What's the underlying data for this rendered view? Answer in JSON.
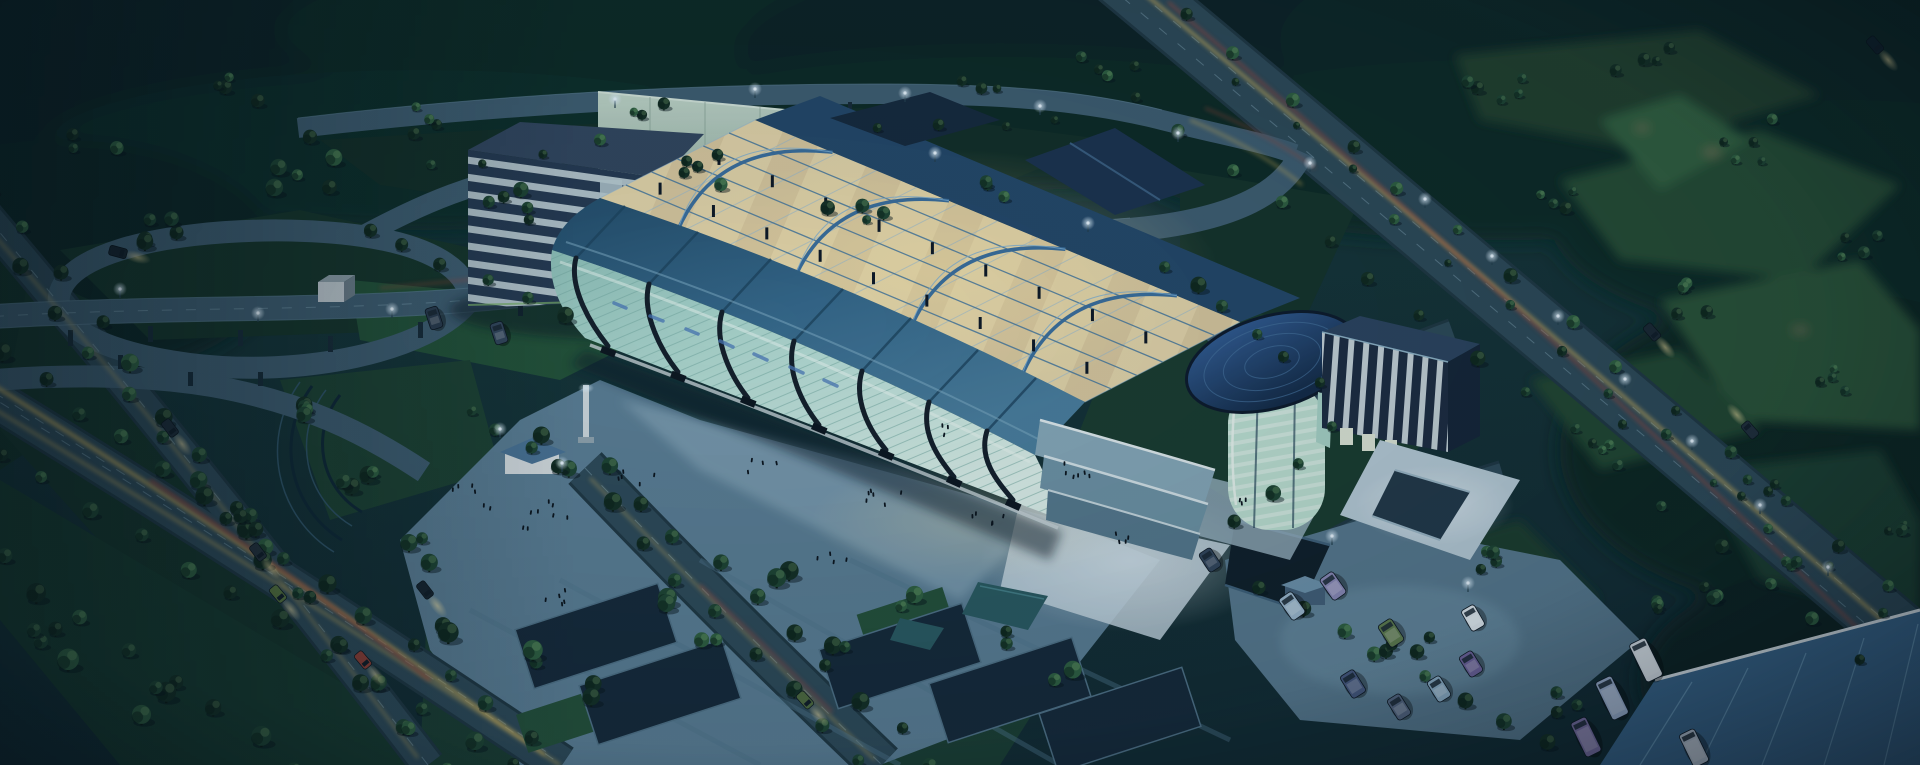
{
  "scene": {
    "subject": "aerial night rendering of a glass exhibition and convention center campus",
    "time_of_day": "dusk",
    "style": "3d-architectural-visualization",
    "features": [
      "highway interchange",
      "office block",
      "curved glass exhibition hall",
      "open steel roof truss",
      "glass tower with dome",
      "plaza with people",
      "tree-lined boulevards with light trails",
      "parking lot with vans and buses",
      "golf course and forest backdrop"
    ]
  },
  "palette": {
    "sky_top": "#0e2730",
    "terrain": "#143136",
    "forest": "#0d2524",
    "lawn": "#16352b",
    "golf_green": "#2c5339",
    "road": "#2e4a59",
    "road_elevated": "#3f5e72",
    "road_casing": "#203844",
    "lane_dash": "#7fa2b4",
    "trail_yellow": "#d7b75e",
    "trail_red": "#a8473a",
    "plaza": "#5b7e95",
    "plaza_lit": "#9db8c8",
    "pool": "#16293a",
    "water": "#2a5a62",
    "glass": "#a8d2ca",
    "glass_light": "#d9efe9",
    "mullion": "#76aaa4",
    "rib": "#141f2b",
    "roof_steel": "#2c5878",
    "roof_steel_light": "#4f88a6",
    "truss_warm": "#d9c89f",
    "truss_bright": "#f0e2b6",
    "truss_blue": "#3b6f9e",
    "navy_building": "#263a52",
    "navy_dark": "#1d2c42",
    "stripe": "#b2c3cb",
    "slab_glass": "#aec6ba",
    "dome": "#1e3d60",
    "cylinder": "#bfe2d4",
    "wing_strip": "#d9e6ea",
    "parking": "#58798f",
    "canopy": "#3a678e",
    "glow_warm": "#ffe9a8",
    "glow_cool": "#dff2ff",
    "tree_dark": "#142f25",
    "tree_mid": "#1e4433",
    "tree_light": "#2f5f41"
  },
  "truss": {
    "front": [
      600,
      198,
      1085,
      402
    ],
    "back": [
      755,
      120,
      1240,
      322
    ],
    "arc_ts": [
      0.16,
      0.4,
      0.64,
      0.87
    ],
    "post_ks": [
      0.2,
      0.58
    ],
    "posts_per_line": 9
  },
  "vegetation": {
    "tree_rows": [
      [
        -5,
        185,
        400,
        730,
        13,
        1.0
      ],
      [
        20,
        268,
        445,
        765,
        13,
        1.0
      ],
      [
        0,
        352,
        530,
        735,
        14,
        1.05
      ],
      [
        -5,
        452,
        520,
        765,
        12,
        1.05
      ],
      [
        0,
        560,
        300,
        765,
        8,
        1.1
      ],
      [
        535,
        430,
        860,
        760,
        10,
        1.0
      ],
      [
        605,
        468,
        935,
        765,
        10,
        1.0
      ],
      [
        1082,
        55,
        1862,
        658,
        17,
        0.85
      ],
      [
        1185,
        12,
        1948,
        630,
        15,
        0.8
      ],
      [
        1240,
        85,
        1880,
        615,
        13,
        0.6
      ],
      [
        1258,
        592,
        1545,
        742,
        8,
        0.9
      ],
      [
        1162,
        262,
        1315,
        382,
        6,
        0.9
      ],
      [
        368,
        232,
        562,
        318,
        6,
        1.0
      ],
      [
        430,
        168,
        600,
        144,
        4,
        0.7
      ],
      [
        880,
        128,
        1060,
        118,
        4,
        0.7
      ],
      [
        1330,
        430,
        1240,
        520,
        4,
        0.9
      ],
      [
        470,
        415,
        560,
        470,
        4,
        0.9
      ]
    ],
    "tree_clusters": [
      [
        150,
        215,
        45,
        5,
        1.0
      ],
      [
        305,
        165,
        50,
        6,
        1.0
      ],
      [
        520,
        205,
        40,
        5,
        0.9
      ],
      [
        705,
        168,
        40,
        5,
        0.85
      ],
      [
        862,
        205,
        35,
        4,
        0.8
      ],
      [
        435,
        122,
        35,
        4,
        0.8
      ],
      [
        245,
        95,
        35,
        4,
        0.8
      ],
      [
        645,
        108,
        30,
        3,
        0.7
      ],
      [
        1000,
        195,
        30,
        3,
        0.75
      ],
      [
        92,
        145,
        28,
        3,
        0.8
      ],
      [
        452,
        620,
        22,
        2,
        1.2
      ],
      [
        525,
        658,
        20,
        2,
        1.15
      ],
      [
        650,
        602,
        20,
        2,
        1.1
      ],
      [
        708,
        648,
        18,
        2,
        1.1
      ],
      [
        778,
        578,
        18,
        2,
        1.05
      ],
      [
        598,
        692,
        18,
        2,
        1.1
      ],
      [
        835,
        642,
        16,
        2,
        1.0
      ],
      [
        908,
        602,
        16,
        2,
        1.0
      ],
      [
        1000,
        640,
        18,
        2,
        1.0
      ],
      [
        1068,
        678,
        18,
        2,
        1.0
      ],
      [
        300,
        422,
        30,
        4,
        0.95
      ],
      [
        362,
        482,
        28,
        4,
        0.95
      ],
      [
        252,
        522,
        26,
        3,
        1.0
      ],
      [
        420,
        552,
        24,
        3,
        1.0
      ],
      [
        1502,
        92,
        40,
        5,
        0.75
      ],
      [
        1645,
        62,
        35,
        4,
        0.7
      ],
      [
        1762,
        142,
        40,
        5,
        0.75
      ],
      [
        1852,
        242,
        35,
        4,
        0.7
      ],
      [
        1562,
        202,
        32,
        4,
        0.7
      ],
      [
        1700,
        302,
        36,
        5,
        0.7
      ],
      [
        1832,
        382,
        30,
        4,
        0.7
      ],
      [
        1602,
        432,
        30,
        4,
        0.7
      ],
      [
        1752,
        482,
        28,
        4,
        0.7
      ],
      [
        1882,
        522,
        24,
        3,
        0.7
      ],
      [
        1502,
        562,
        28,
        4,
        0.75
      ],
      [
        1405,
        642,
        26,
        4,
        0.8
      ],
      [
        1652,
        602,
        22,
        3,
        0.75
      ],
      [
        1562,
        702,
        20,
        3,
        0.9
      ],
      [
        1705,
        598,
        22,
        3,
        0.8
      ],
      [
        1802,
        562,
        20,
        3,
        0.75
      ],
      [
        975,
        95,
        28,
        3,
        0.7
      ],
      [
        1120,
        70,
        26,
        3,
        0.65
      ],
      [
        60,
        640,
        40,
        4,
        1.2
      ],
      [
        140,
        700,
        36,
        3,
        1.2
      ]
    ]
  },
  "vehicles": {
    "parked": [
      {
        "x": 1292,
        "y": 606,
        "r": -35,
        "w": 16,
        "h": 26,
        "c": "#9db9cf"
      },
      {
        "x": 1333,
        "y": 586,
        "r": -35,
        "w": 16,
        "h": 26,
        "c": "#8b8ab8"
      },
      {
        "x": 1391,
        "y": 633,
        "r": -33,
        "w": 16,
        "h": 26,
        "c": "#5e7b4e"
      },
      {
        "x": 1473,
        "y": 618,
        "r": -30,
        "w": 15,
        "h": 24,
        "c": "#dfe8ee"
      },
      {
        "x": 1353,
        "y": 684,
        "r": -32,
        "w": 16,
        "h": 26,
        "c": "#46587e"
      },
      {
        "x": 1399,
        "y": 707,
        "r": -32,
        "w": 15,
        "h": 24,
        "c": "#54657f"
      },
      {
        "x": 1439,
        "y": 689,
        "r": -32,
        "w": 15,
        "h": 24,
        "c": "#8fb0c9"
      },
      {
        "x": 1471,
        "y": 664,
        "r": -32,
        "w": 15,
        "h": 24,
        "c": "#6f649c"
      },
      {
        "x": 1646,
        "y": 660,
        "r": -26,
        "w": 18,
        "h": 42,
        "c": "#dfe7ee"
      },
      {
        "x": 1612,
        "y": 698,
        "r": -26,
        "w": 18,
        "h": 42,
        "c": "#9fb2d2"
      },
      {
        "x": 1586,
        "y": 737,
        "r": -26,
        "w": 17,
        "h": 38,
        "c": "#7a6fa4"
      },
      {
        "x": 1694,
        "y": 748,
        "r": -26,
        "w": 17,
        "h": 36,
        "c": "#b9c4d4"
      },
      {
        "x": 434,
        "y": 318,
        "r": -18,
        "w": 13,
        "h": 22,
        "c": "#2a3b4e"
      },
      {
        "x": 499,
        "y": 333,
        "r": -18,
        "w": 13,
        "h": 22,
        "c": "#33465c"
      },
      {
        "x": 1210,
        "y": 560,
        "r": -33,
        "w": 14,
        "h": 22,
        "c": "#32455c"
      }
    ],
    "moving": [
      {
        "x": 170,
        "y": 428,
        "r": 143,
        "c": "#1d2b38"
      },
      {
        "x": 258,
        "y": 552,
        "r": 143,
        "c": "#24313c"
      },
      {
        "x": 278,
        "y": 594,
        "r": 140,
        "c": "#57743f"
      },
      {
        "x": 363,
        "y": 660,
        "r": 140,
        "c": "#8e3f36"
      },
      {
        "x": 425,
        "y": 590,
        "r": 142,
        "c": "#17242f"
      },
      {
        "x": 805,
        "y": 700,
        "r": 138,
        "c": "#4e6a3f"
      },
      {
        "x": 1652,
        "y": 332,
        "r": 139,
        "c": "#1a2733"
      },
      {
        "x": 1750,
        "y": 430,
        "r": -41,
        "c": "#202e3b"
      },
      {
        "x": 1875,
        "y": 45,
        "r": 139,
        "c": "#10202c"
      },
      {
        "x": 118,
        "y": 252,
        "r": 105,
        "c": "#16232e"
      }
    ]
  },
  "street_lights": [
    [
      615,
      108
    ],
    [
      755,
      98
    ],
    [
      905,
      102
    ],
    [
      1040,
      115
    ],
    [
      1178,
      142
    ],
    [
      1310,
      172
    ],
    [
      120,
      298
    ],
    [
      258,
      322
    ],
    [
      392,
      318
    ],
    [
      1425,
      208
    ],
    [
      1492,
      265
    ],
    [
      1558,
      325
    ],
    [
      1625,
      388
    ],
    [
      1692,
      450
    ],
    [
      1760,
      514
    ],
    [
      1828,
      576
    ],
    [
      500,
      438
    ],
    [
      562,
      472
    ],
    [
      935,
      162
    ],
    [
      1088,
      232
    ],
    [
      1332,
      545
    ],
    [
      1468,
      592
    ]
  ],
  "people": {
    "groups": [
      [
        470,
        500,
        6,
        28
      ],
      [
        545,
        520,
        8,
        30
      ],
      [
        640,
        480,
        5,
        22
      ],
      [
        762,
        470,
        4,
        18
      ],
      [
        880,
        500,
        6,
        24
      ],
      [
        992,
        520,
        5,
        20
      ],
      [
        1082,
        472,
        6,
        22
      ],
      [
        1122,
        542,
        4,
        16
      ],
      [
        832,
        562,
        4,
        16
      ],
      [
        942,
        432,
        3,
        12
      ],
      [
        556,
        600,
        5,
        20
      ],
      [
        1240,
        498,
        3,
        14
      ]
    ]
  }
}
